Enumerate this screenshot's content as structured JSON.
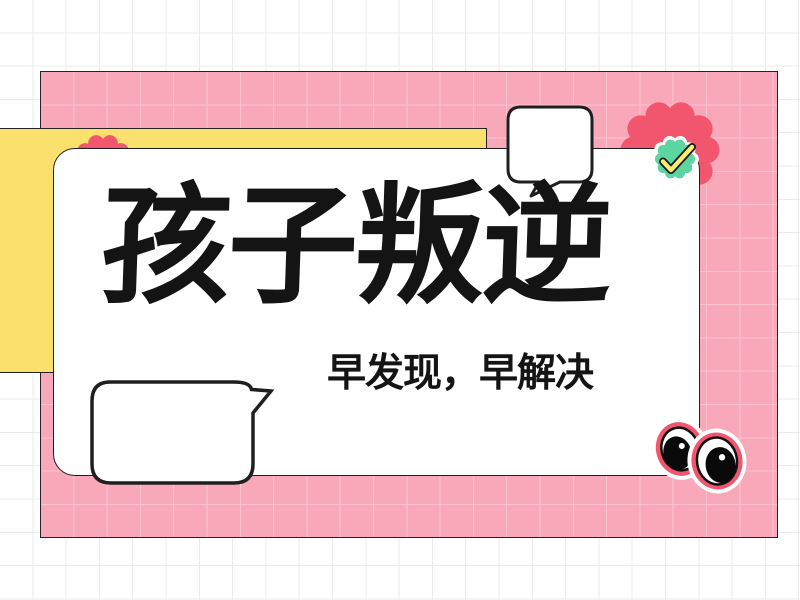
{
  "poster": {
    "title": "孩子叛逆",
    "subtitle": "早发现，早解决"
  },
  "icons": {
    "top_speech_bubble": "speech-bubble-icon",
    "bottom_speech_bubble": "speech-bubble-icon",
    "check_badge": "check-badge-icon",
    "googly_eyes": "googly-eyes-icon",
    "flower_top_right": "flower-blob-icon",
    "flower_top_left": "flower-blob-icon"
  },
  "colors": {
    "background": "#FFFFFF",
    "background_grid": "#EBEBEB",
    "pink_panel": "#F9A8BA",
    "pink_panel_grid": "#FCC3CF",
    "accent_pink": "#F2566F",
    "yellow_panel": "#FBE06E",
    "badge_green": "#5DD5A2",
    "check_yellow": "#F7ED6E",
    "text": "#141414",
    "outline": "#1F1F1F"
  }
}
